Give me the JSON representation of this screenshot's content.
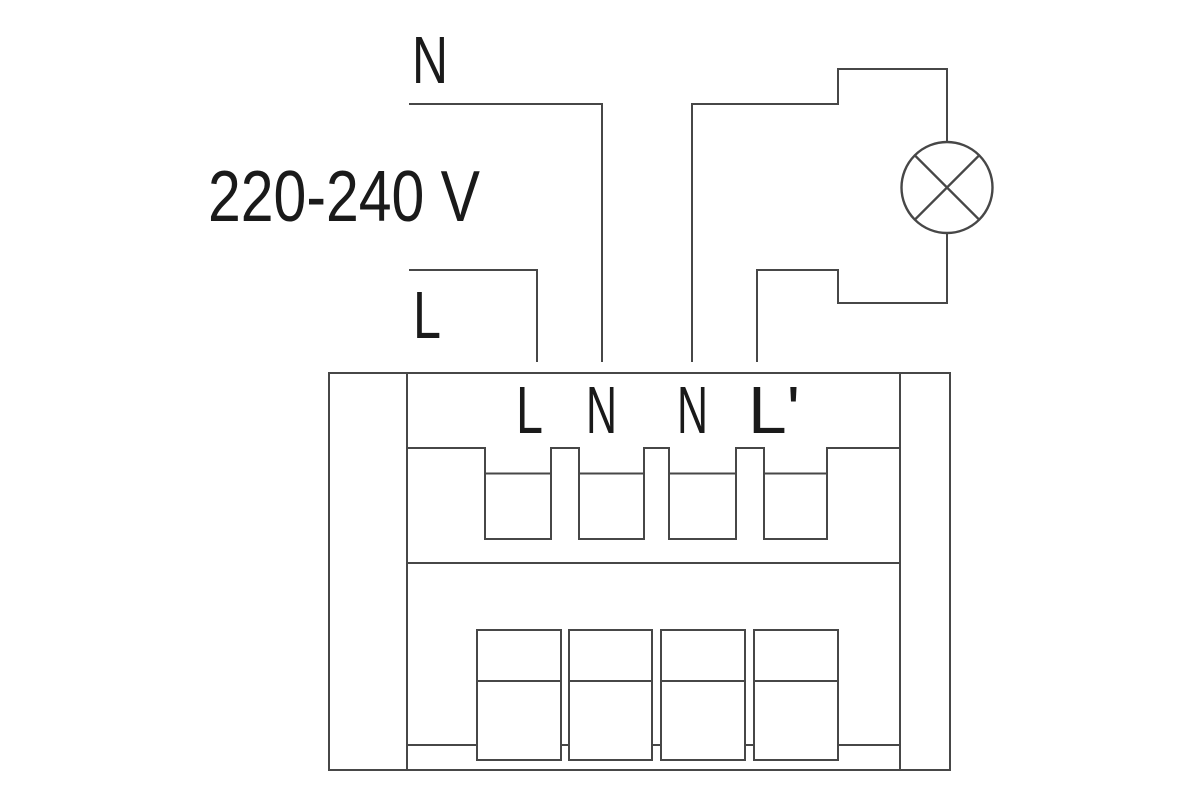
{
  "colors": {
    "line": "#474747",
    "text": "#1a1a1a",
    "background": "#ffffff"
  },
  "supply": {
    "neutral_label": "N",
    "voltage_label": "220-240 V",
    "live_label": "L"
  },
  "terminals": [
    {
      "label": "L"
    },
    {
      "label": "N"
    },
    {
      "label": "N"
    },
    {
      "label": "L'"
    }
  ],
  "icons": {
    "load": "lamp-icon"
  }
}
